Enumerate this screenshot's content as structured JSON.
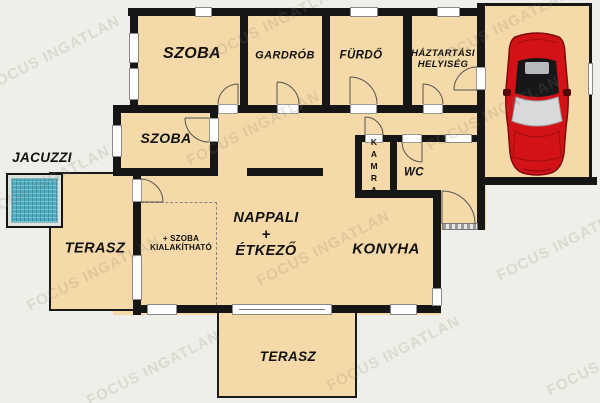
{
  "title": "Floor plan",
  "watermark": "FOCUS INGATLAN",
  "labels": {
    "szoba_top": "SZOBA",
    "gardrob": "GARDRÓB",
    "furdo": "FÜRDŐ",
    "haztartasi": "HÁZTARTÁSI\nHELYISÉG",
    "szoba_middle": "SZOBA",
    "jacuzzi": "JACUZZI",
    "terasz_left": "TERASZ",
    "nappali_etkezo": "NAPPALI\n+\nÉTKEZŐ",
    "szoba_kialakithato": "+ SZOBA\nKIALAKÍTHATÓ",
    "kamra": "KAMRA",
    "wc": "WC",
    "konyha": "KONYHA",
    "terasz_bottom": "TERASZ"
  },
  "colors": {
    "background": "#efeee8",
    "room_fill": "#f5d9a8",
    "wall": "#161616",
    "jacuzzi_water": "#4fadc1",
    "car_body": "#d31217",
    "watermark": "#7d7d74"
  }
}
